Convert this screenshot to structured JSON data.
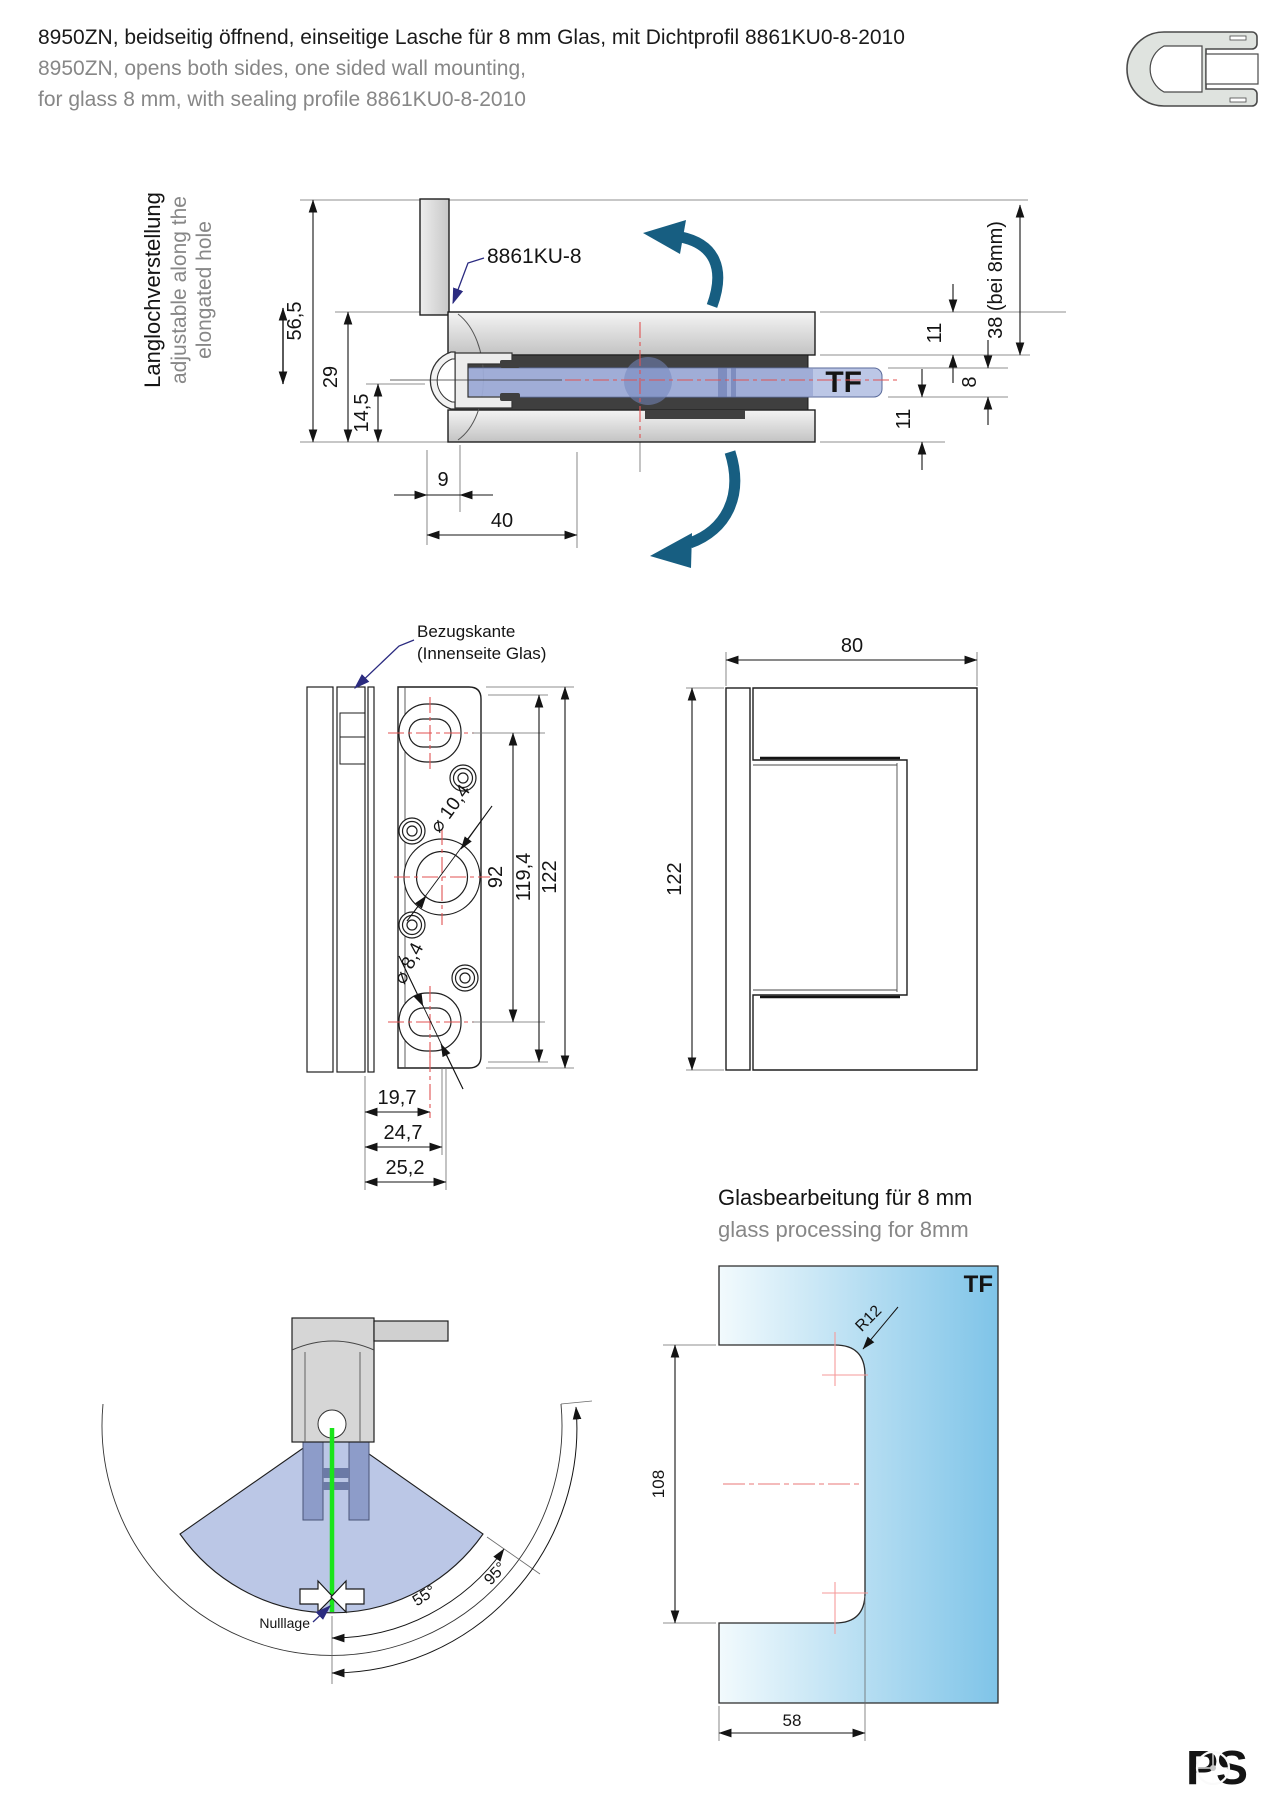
{
  "header": {
    "title_de": "8950ZN, beidseitig öffnend, einseitige Lasche für 8 mm Glas, mit Dichtprofil 8861KU0-8-2010",
    "title_en1": "8950ZN, opens both sides, one sided wall mounting,",
    "title_en2": "for glass 8 mm, with sealing profile 8861KU0-8-2010"
  },
  "side_view": {
    "adjust_note_de": "Langlochverstellung",
    "adjust_note_en1": "adjustable along the",
    "adjust_note_en2": "elongated hole",
    "seal_label": "8861KU-8",
    "glass_label": "TF",
    "dim_total_height": "56,5",
    "dim_body_height": "29",
    "dim_lower": "14,5",
    "dim_wall_width": "9",
    "dim_depth": "40",
    "dim_top_plate": "11",
    "dim_glass": "8",
    "dim_bottom_plate": "11",
    "dim_overall": "38 (bei 8mm)"
  },
  "front_view": {
    "ref_label1": "Bezugskante",
    "ref_label2": "(Innenseite Glas)",
    "dim_hole_large": "⌀ 10,4",
    "dim_hole_small": "⌀ 8,4",
    "dim_pitch": "92",
    "dim_height2": "119,4",
    "dim_height": "122",
    "dim_w1": "19,7",
    "dim_w2": "24,7",
    "dim_w3": "25,2"
  },
  "end_view": {
    "dim_width": "80",
    "dim_height": "122"
  },
  "swing_view": {
    "zero_label": "Nulllage",
    "angle_inner": "55°",
    "angle_outer": "95°"
  },
  "glass_view": {
    "heading_de": "Glasbearbeitung für 8 mm",
    "heading_en": "glass processing for 8mm",
    "glass_label": "TF",
    "dim_height": "108",
    "dim_width": "58",
    "dim_radius": "R12"
  },
  "logo_text": "PS",
  "colors": {
    "accent_blue": "#1b7fc0",
    "teal_arrow": "#175e81",
    "centerline_red": "#e05252",
    "leader_navy": "#2b2b80",
    "glass_blue": "#b6c2e4",
    "highlight_green": "#1ae51a"
  }
}
